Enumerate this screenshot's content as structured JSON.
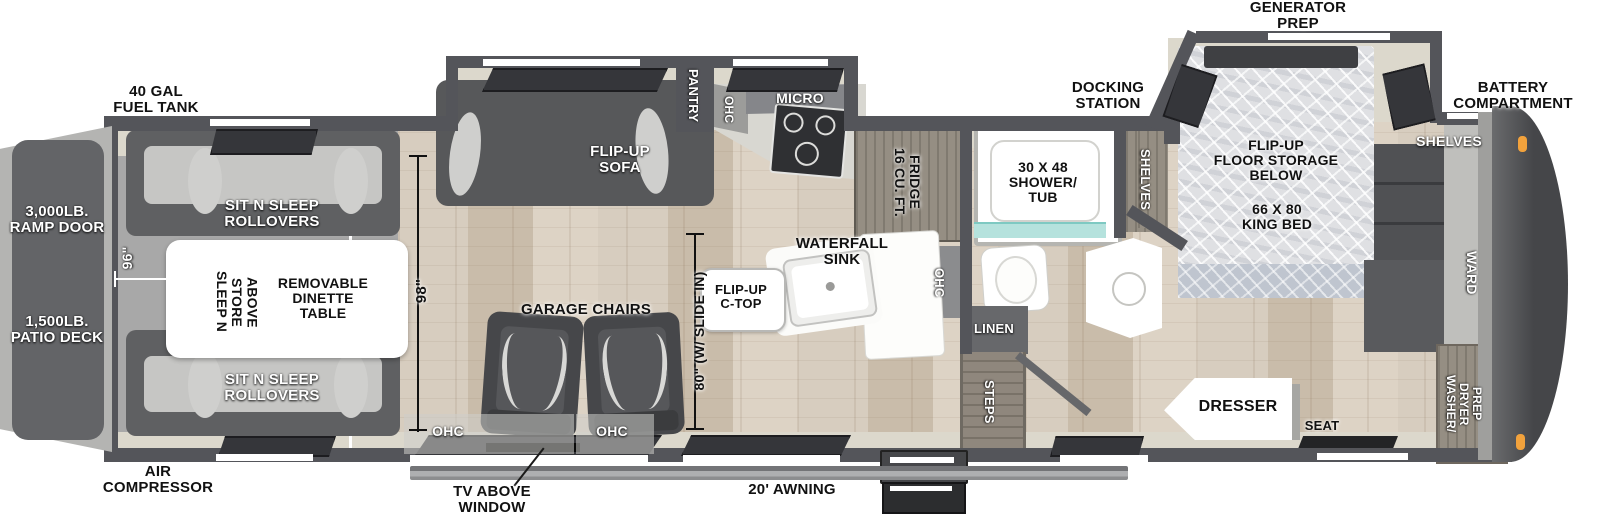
{
  "title": "Toy hauler fifth wheel floor plan",
  "labels": {
    "exterior": {
      "fuel_tank": "40 GAL\nFUEL TANK",
      "air_compressor": "AIR\nCOMPRESSOR",
      "ramp_door": "3,000LB.\nRAMP DOOR",
      "patio_deck": "1,500LB.\nPATIO DECK",
      "generator_prep": "GENERATOR\nPREP",
      "battery_compartment": "BATTERY\nCOMPARTMENT",
      "docking_station": "DOCKING\nSTATION",
      "awning": "20' AWNING",
      "tv_above_window": "TV ABOVE\nWINDOW"
    },
    "garage": {
      "sit_n_sleep_top": "SIT N SLEEP\nROLLOVERS",
      "sit_n_sleep_bottom": "SIT N SLEEP\nROLLOVERS",
      "sleep_n_store": "SLEEP N STORE\nABOVE",
      "dinette": "REMOVABLE\nDINETTE\nTABLE",
      "garage_chairs": "GARAGE CHAIRS",
      "ohc_left": "OHC",
      "ohc_right": "OHC"
    },
    "kitchen": {
      "flip_up_sofa": "FLIP-UP\nSOFA",
      "pantry": "PANTRY",
      "ohc_top": "OHC",
      "micro": "MICRO",
      "fridge": "16 CU. FT.\nFRIDGE",
      "ohc_side": "OHC",
      "waterfall_sink": "WATERFALL\nSINK",
      "flip_up_ctop": "FLIP-UP\nC-TOP"
    },
    "bath": {
      "shower_tub": "30 X 48\nSHOWER/\nTUB",
      "linen": "LINEN",
      "steps": "STEPS",
      "shelves": "SHELVES"
    },
    "bedroom": {
      "bed_storage": "FLIP-UP\nFLOOR STORAGE\nBELOW",
      "king_bed": "66 X 80\nKING BED",
      "shelves": "SHELVES",
      "ward": "WARD",
      "washer_dryer": "WASHER/\nDRYER\nPREP",
      "dresser": "DRESSER",
      "seat": "SEAT"
    }
  },
  "dimensions": {
    "garage_width": "96\"",
    "garage_length": "98\"",
    "slide_width": "80\" (W/ SLIDE IN)"
  },
  "colors": {
    "wall": "#54555a",
    "wood_floor": "#d3c8b9",
    "garage_floor": "#a8a8a8",
    "interior_trim": "#dcd8cc",
    "shower_glass": "#b5e2dd",
    "marker_light": "#f2a23c",
    "front_cap": "#454649"
  }
}
